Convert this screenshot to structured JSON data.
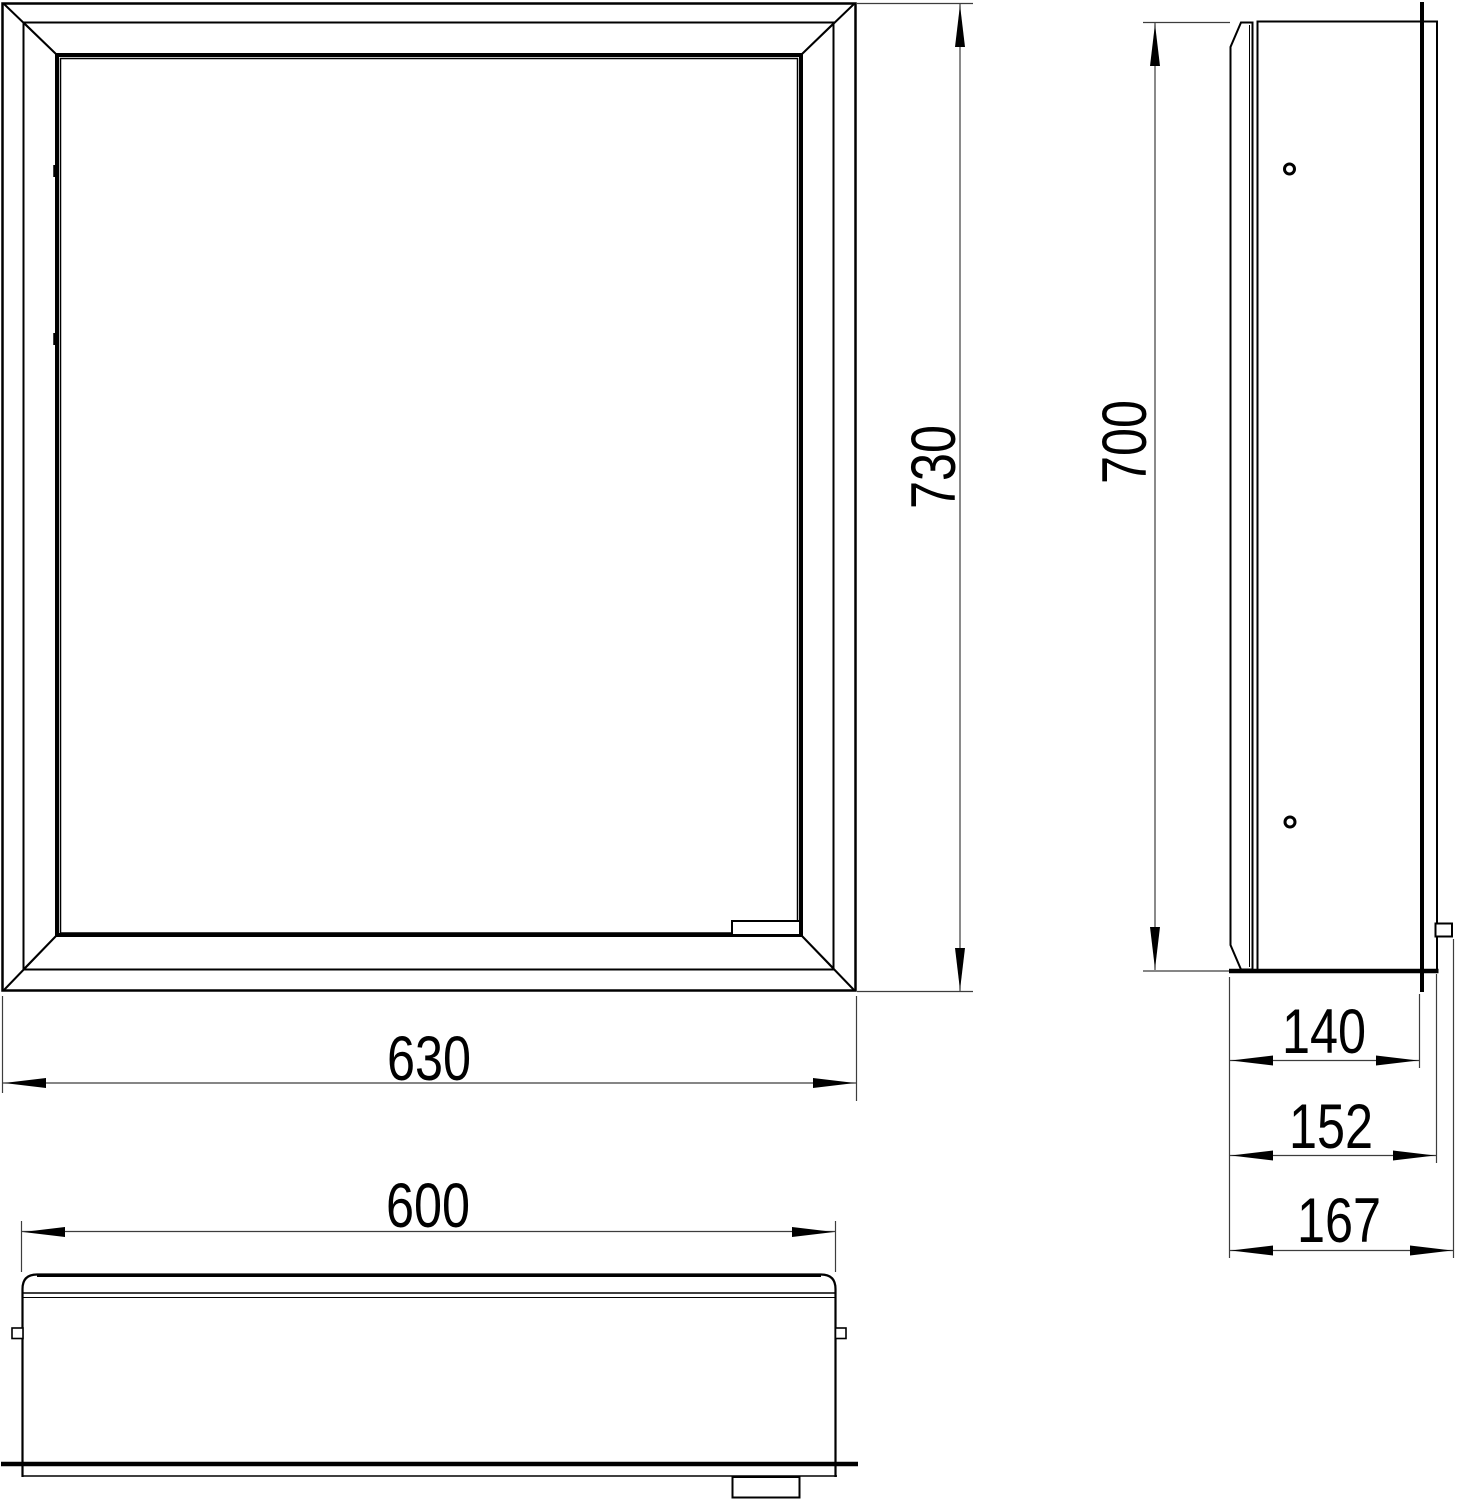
{
  "drawing": {
    "type": "technical-dimension-drawing",
    "subject": "recessed mirror cabinet, three orthographic views",
    "views": {
      "front": {
        "label": "front-view",
        "width_label": "630",
        "height_label": "730"
      },
      "side": {
        "label": "side-view",
        "height_label": "700",
        "depth_box_label": "140",
        "depth_frame_label": "152",
        "depth_total_label": "167"
      },
      "bottom": {
        "label": "bottom-view",
        "width_label": "600"
      }
    },
    "colors": {
      "line": "#000000",
      "dimension_line": "#3d3d3d",
      "background": "#ffffff"
    }
  }
}
